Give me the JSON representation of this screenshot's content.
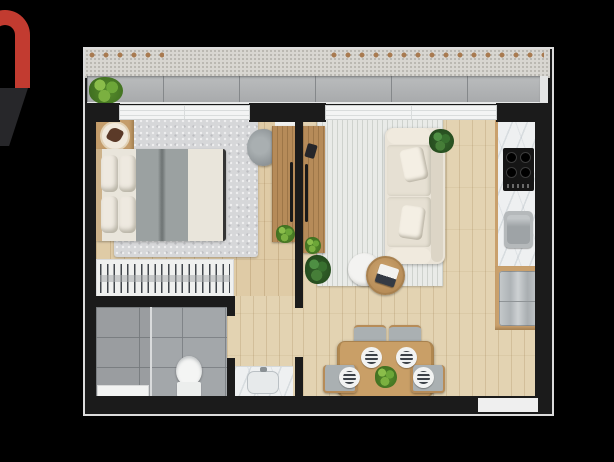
{
  "scene": {
    "type": "apartment-floor-plan-render",
    "background": "#000000",
    "aria": {
      "screen": "black canvas with 3D-rendered studio apartment floor plan",
      "plan": "top-down 3D floor plan of a one-bedroom apartment with balcony",
      "logo": "partial red letter-n logo fragment at left edge"
    },
    "rooms": [
      {
        "name": "balcony",
        "features": [
          "concrete-ledge",
          "tiled-deck",
          "potted-plant",
          "two-sliding-window-bands"
        ]
      },
      {
        "name": "bedroom",
        "features": [
          "double-bed",
          "four-pillows",
          "gray-blanket",
          "shag-rug",
          "nightstand-with-tray",
          "accent-chair",
          "folded-towels",
          "wood-media-panel",
          "open-wardrobe-with-hangers"
        ]
      },
      {
        "name": "bathroom",
        "features": [
          "walk-in-shower",
          "glass-partition",
          "toilet",
          "white-bath-mat"
        ]
      },
      {
        "name": "hall",
        "features": [
          "marble-vanity-with-sink",
          "doorway-to-living-room",
          "doorway-to-bathroom"
        ]
      },
      {
        "name": "living-room",
        "features": [
          "cream-three-seat-sofa",
          "two-throw-pillows",
          "ribbed-rug",
          "round-wood-coffee-table",
          "round-white-side-table",
          "book-stack-decor",
          "floor-plants",
          "wood-media-panel"
        ]
      },
      {
        "name": "dining-area",
        "features": [
          "wood-dining-table",
          "four-gray-chairs",
          "four-striped-place-settings",
          "centerpiece-plant"
        ]
      },
      {
        "name": "kitchen",
        "features": [
          "marble-counter-run",
          "four-burner-cooktop",
          "stainless-sink",
          "refrigerator-in-wood-cabinet"
        ]
      },
      {
        "name": "entry",
        "features": [
          "door-opening-in-south-wall"
        ]
      }
    ],
    "colors": {
      "background": "#000000",
      "logo_red": "#c23b30",
      "wall_black": "#1b1b1b",
      "frame_white": "#dcdcdc",
      "wood_floor": "#e0cda8",
      "bedroom_rug_gray": "#d6d7d9",
      "living_rug_cream": "#e9ebe8",
      "marble_white": "#eef0f1",
      "cabinet_wood": "#c9a06c",
      "sofa_cream": "#eae4d8",
      "bath_tile_gray": "#a3a7aa",
      "balcony_gray": "#b0b2b4",
      "ledge_concrete": "#d8d6d1",
      "plant_green": "#6ca638",
      "cooktop_black": "#151515",
      "stainless_gray": "#b5b9bb"
    }
  }
}
